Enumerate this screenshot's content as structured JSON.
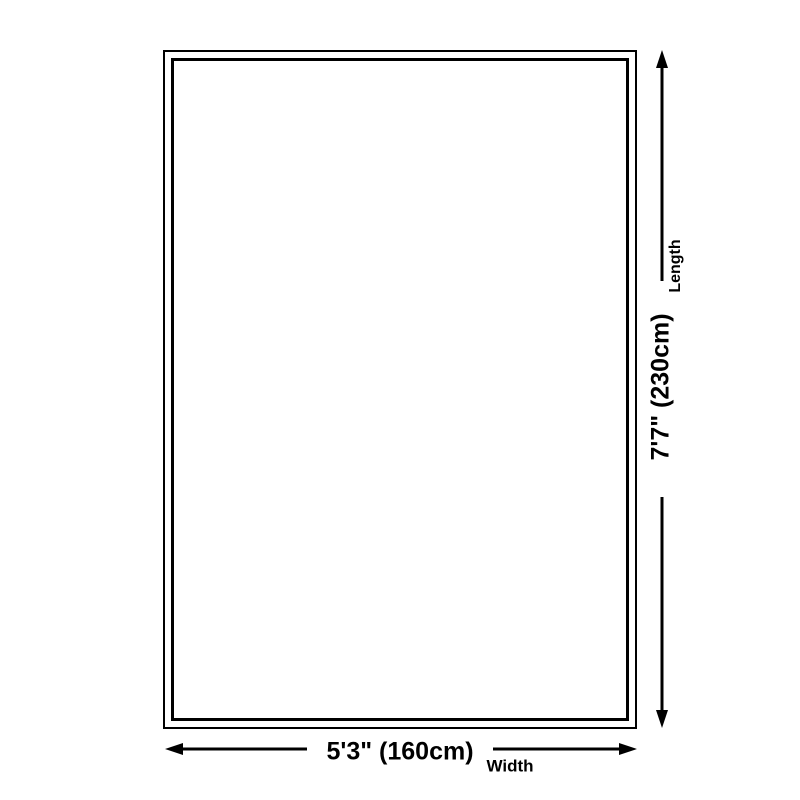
{
  "diagram": {
    "length": {
      "value": "7'7\" (230cm)",
      "label": "Length"
    },
    "width": {
      "value": "5'3\" (160cm)",
      "label": "Width"
    },
    "colors": {
      "line": "#000000",
      "text": "#000000",
      "background": "#ffffff"
    }
  }
}
